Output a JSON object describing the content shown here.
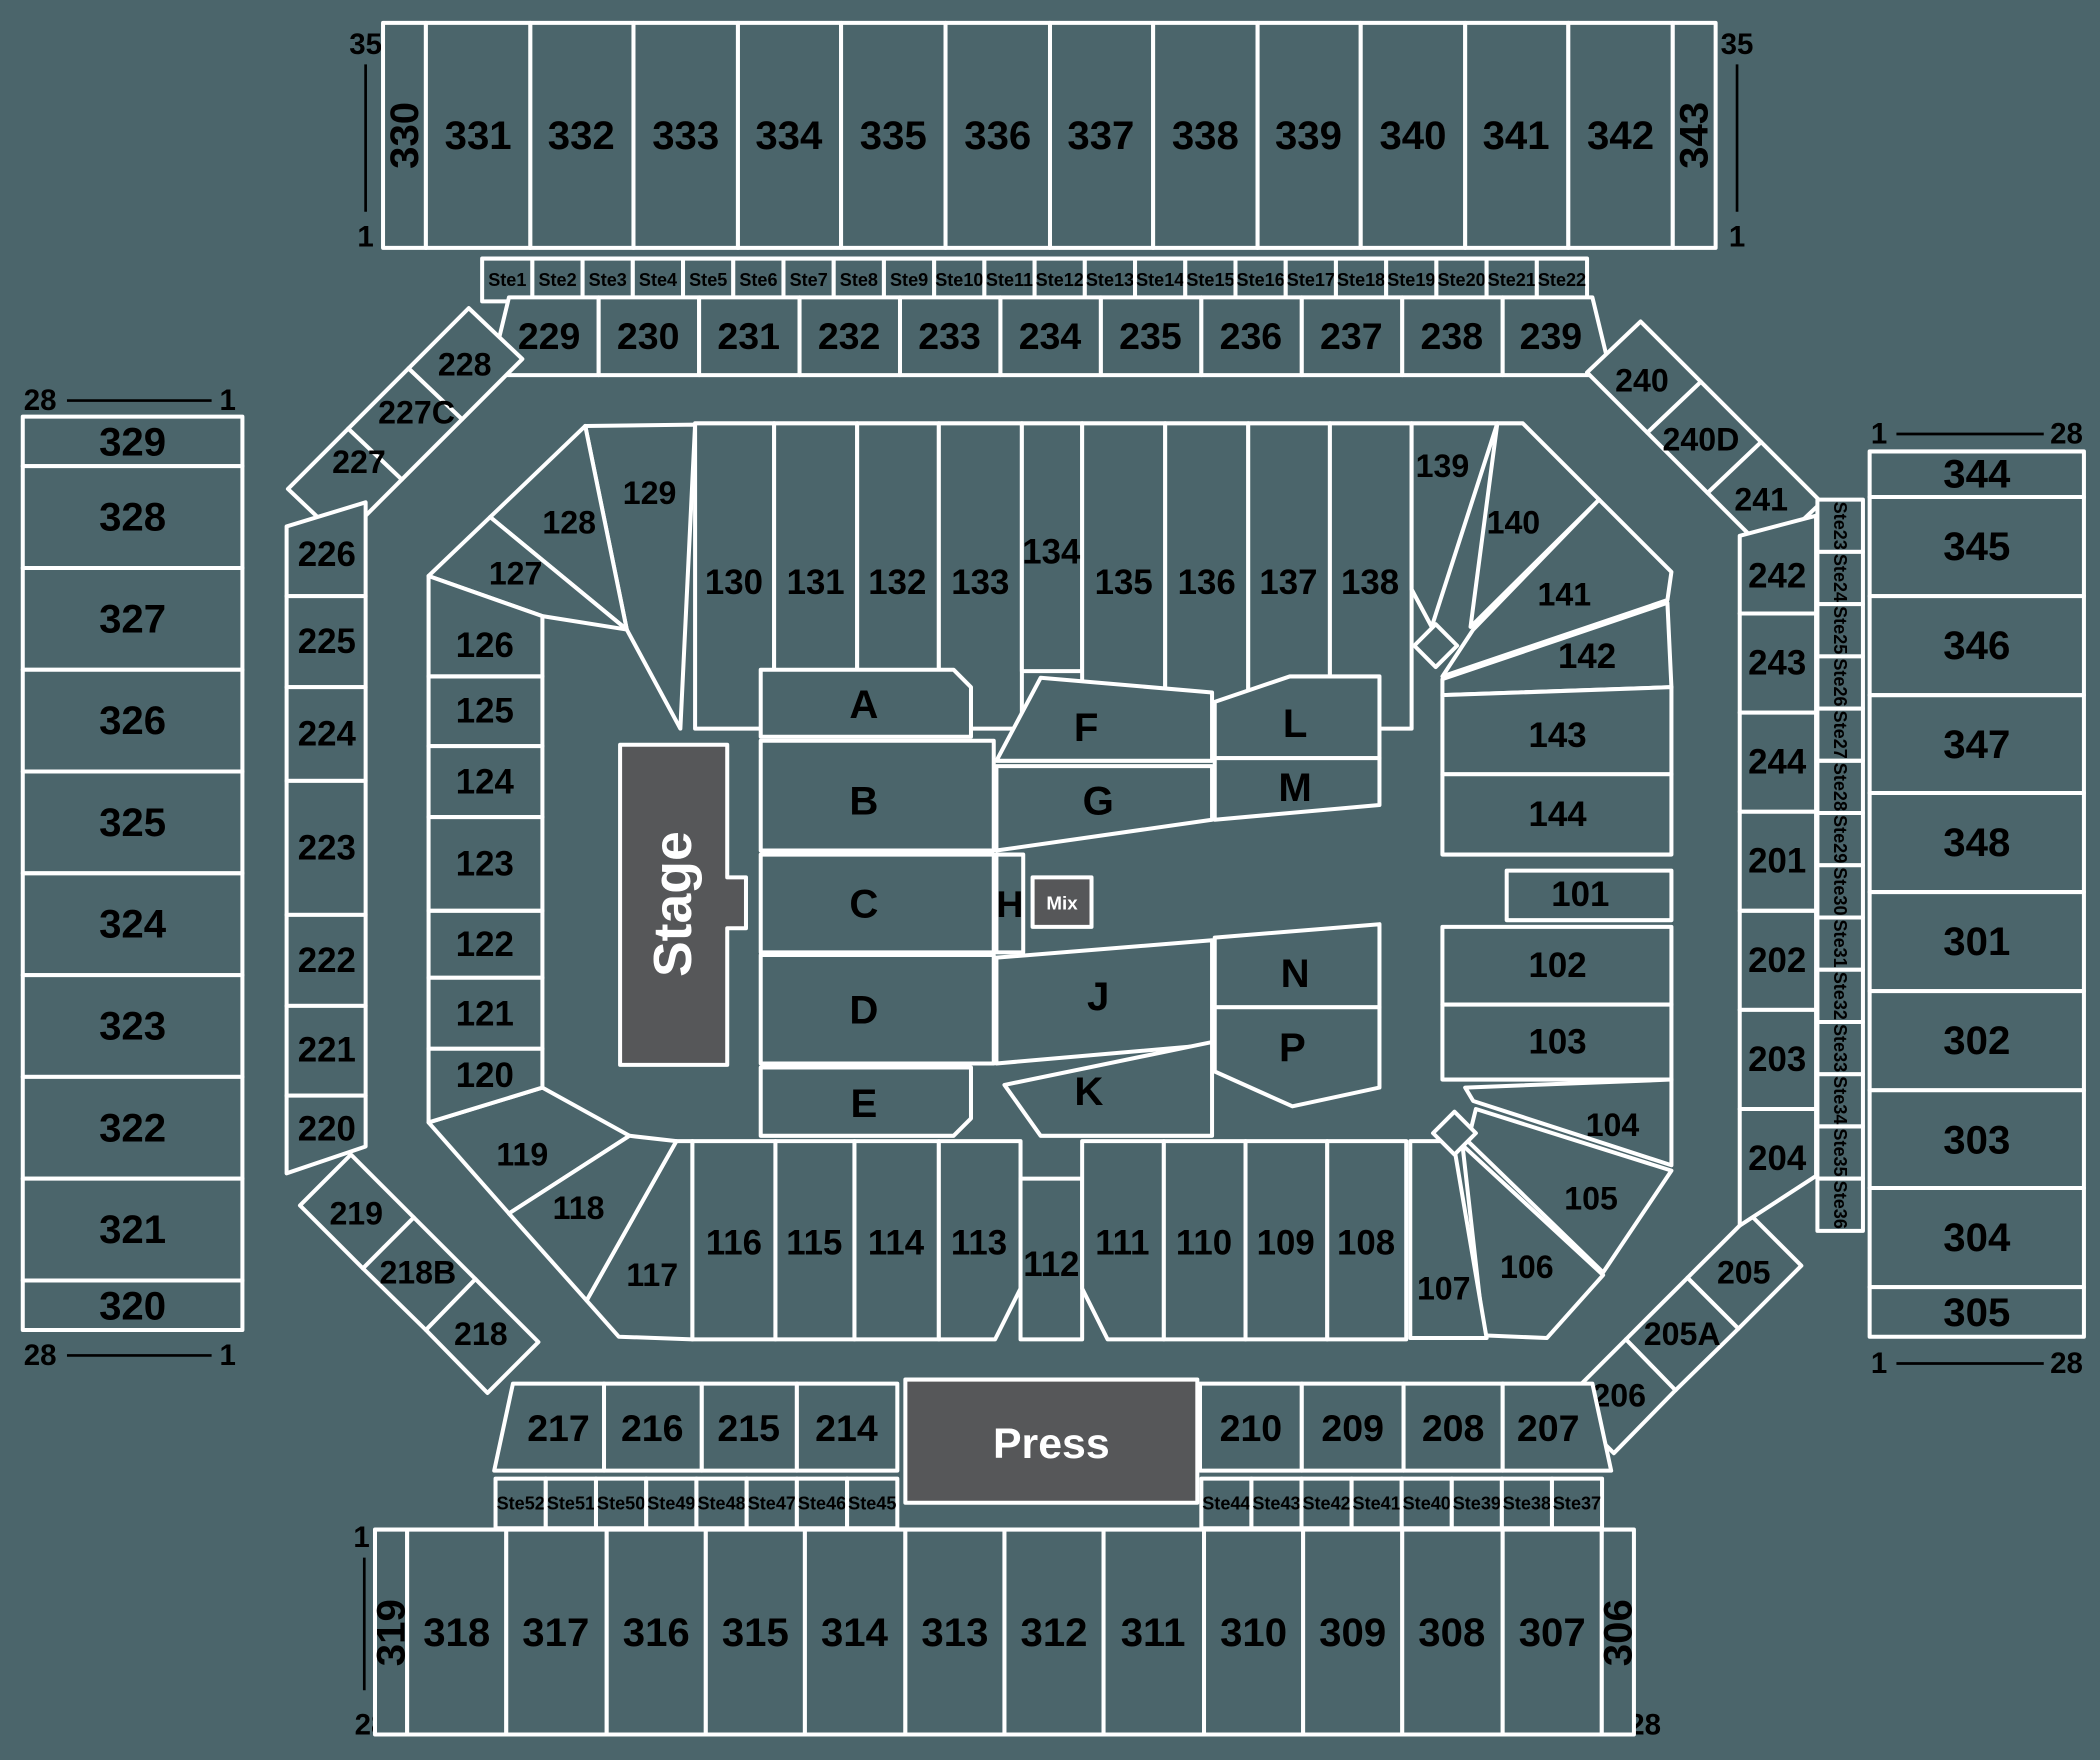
{
  "colors": {
    "background": "#4b656b",
    "stage_fill": "#565759",
    "border": "#ffffff",
    "label": "#000000",
    "light_label": "#ffffff"
  },
  "markers": {
    "m35": "35",
    "m28": "28",
    "m1": "1"
  },
  "floor": {
    "stage": "Stage",
    "press": "Press",
    "mix": "Mix",
    "rows": [
      "A",
      "B",
      "C",
      "D",
      "E",
      "F",
      "G",
      "H",
      "J",
      "K",
      "L",
      "M",
      "N",
      "P"
    ]
  },
  "sections": {
    "top_outer": [
      "330",
      "331",
      "332",
      "333",
      "334",
      "335",
      "336",
      "337",
      "338",
      "339",
      "340",
      "341",
      "342",
      "343"
    ],
    "top_suites": [
      "Ste1",
      "Ste2",
      "Ste3",
      "Ste4",
      "Ste5",
      "Ste6",
      "Ste7",
      "Ste8",
      "Ste9",
      "Ste10",
      "Ste11",
      "Ste12",
      "Ste13",
      "Ste14",
      "Ste15",
      "Ste16",
      "Ste17",
      "Ste18",
      "Ste19",
      "Ste20",
      "Ste21",
      "Ste22"
    ],
    "upper_200_band": [
      "229",
      "230",
      "231",
      "232",
      "233",
      "234",
      "235",
      "236",
      "237",
      "238",
      "239"
    ],
    "corner_top_left": [
      "228",
      "227C",
      "227"
    ],
    "corner_top_right": [
      "240",
      "240D",
      "241"
    ],
    "corner_bottom_left": [
      "219",
      "218B",
      "218"
    ],
    "corner_bottom_right": [
      "205",
      "205A",
      "206"
    ],
    "left_outer": [
      "329",
      "328",
      "327",
      "326",
      "325",
      "324",
      "323",
      "322",
      "321",
      "320"
    ],
    "right_outer": [
      "344",
      "345",
      "346",
      "347",
      "348",
      "301",
      "302",
      "303",
      "304",
      "305"
    ],
    "left_ring": [
      "226",
      "225",
      "224",
      "223",
      "222",
      "221",
      "220"
    ],
    "right_ring": [
      "242",
      "243",
      "244",
      "201",
      "202",
      "203",
      "204"
    ],
    "right_suites": [
      "Ste23",
      "Ste24",
      "Ste25",
      "Ste26",
      "Ste27",
      "Ste28",
      "Ste29",
      "Ste30",
      "Ste31",
      "Ste32",
      "Ste33",
      "Ste34",
      "Ste35",
      "Ste36"
    ],
    "bowl_top": [
      "129",
      "130",
      "131",
      "132",
      "133",
      "134",
      "135",
      "136",
      "137",
      "138"
    ],
    "bowl_top_left": [
      "128",
      "127"
    ],
    "bowl_top_right": [
      "139",
      "140",
      "141"
    ],
    "bowl_right": [
      "142",
      "143",
      "144",
      "101",
      "102",
      "103"
    ],
    "bowl_bottom_right": [
      "104",
      "105",
      "106",
      "107"
    ],
    "bowl_bottom": [
      "117",
      "116",
      "115",
      "114",
      "113",
      "112",
      "111",
      "110",
      "109",
      "108"
    ],
    "bowl_bottom_left": [
      "119",
      "118"
    ],
    "bowl_left": [
      "126",
      "125",
      "124",
      "123",
      "122",
      "121",
      "120"
    ],
    "lower_200_band": [
      "217",
      "216",
      "215",
      "214",
      "210",
      "209",
      "208",
      "207"
    ],
    "bottom_suites": [
      "Ste52",
      "Ste51",
      "Ste50",
      "Ste49",
      "Ste48",
      "Ste47",
      "Ste46",
      "Ste45",
      "Ste44",
      "Ste43",
      "Ste42",
      "Ste41",
      "Ste40",
      "Ste39",
      "Ste38",
      "Ste37"
    ],
    "bottom_outer": [
      "319",
      "318",
      "317",
      "316",
      "315",
      "314",
      "313",
      "312",
      "311",
      "310",
      "309",
      "308",
      "307",
      "306"
    ]
  }
}
